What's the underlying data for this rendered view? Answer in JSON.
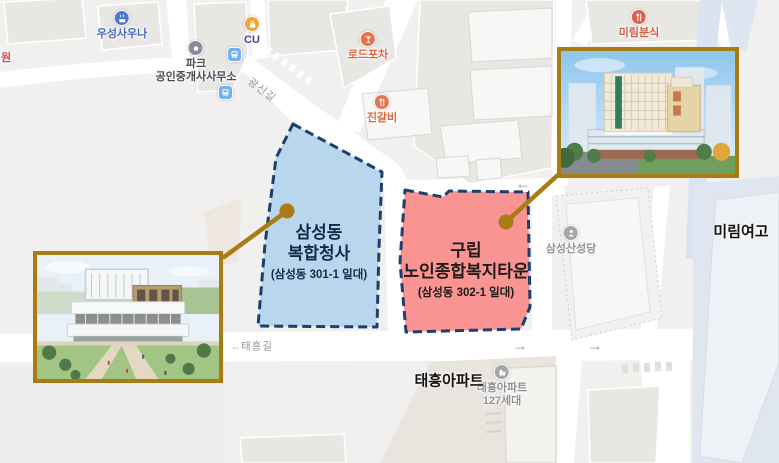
{
  "site_labels": {
    "blue": {
      "line1": "삼성동",
      "line2": "복합청사",
      "sub": "(삼성동 301-1 일대)"
    },
    "red": {
      "line1": "구립",
      "line2": "노인종합복지타운",
      "sub": "(삼성동 302-1 일대)"
    }
  },
  "colors": {
    "blue_site_fill": "#b4d5ec",
    "red_site_fill": "#f98e8c",
    "site_border": "#1d3f6e",
    "connector_gold": "#a87c12",
    "school_zone_fill": "#dfe6ef",
    "stream_fill": "#d9e3f1"
  },
  "pois": [
    {
      "label": "우성사우나"
    },
    {
      "label": "파크",
      "label2": "공인중개사사무소"
    },
    {
      "label": "CU"
    },
    {
      "label": "로드포차"
    },
    {
      "label": "진갈비"
    },
    {
      "label": "미림분식"
    },
    {
      "label": "삼성산성당"
    },
    {
      "label": "태흥아파트",
      "label2": "127세대"
    },
    {
      "label": "원"
    }
  ],
  "road_labels": {
    "gwangsin": "광신길",
    "taeheung": "태흥길"
  },
  "area_labels": {
    "school": "미림여고",
    "apartment": "태흥아파트"
  },
  "arrows": {
    "left": "←",
    "right": "→"
  }
}
